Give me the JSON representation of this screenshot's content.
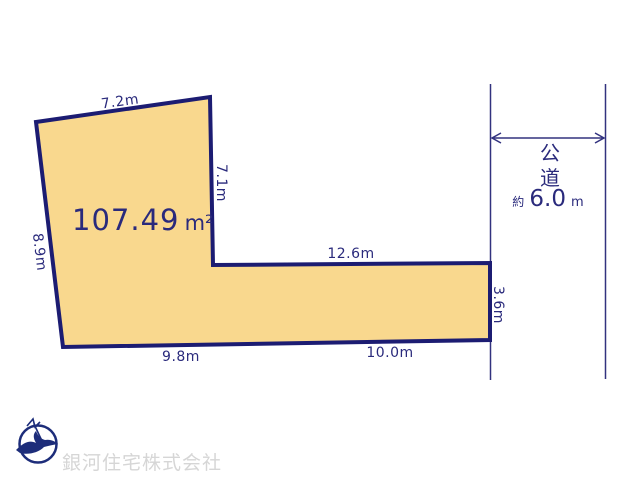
{
  "plot": {
    "area": {
      "value": "107.49",
      "unit": "m²"
    },
    "edges": {
      "top": "7.2m",
      "right_upper": "7.1m",
      "left": "8.9m",
      "inner_top": "12.6m",
      "right_lower": "3.6m",
      "bottom_left": "9.8m",
      "bottom_right": "10.0m"
    }
  },
  "road": {
    "name_chars": [
      "公",
      "道"
    ],
    "width": {
      "prefix": "約",
      "value": "6.0",
      "unit": "m"
    }
  },
  "footer": {
    "company_name": "銀河住宅株式会社",
    "logo_icon": "bird-compass-logo"
  },
  "colors": {
    "plot_fill": "#f9d88e",
    "plot_outline": "#1c1c72",
    "dimension_text": "#2a2a7c",
    "road_line": "#32327f",
    "company_text": "#d6d6d6",
    "logo_navy": "#1d2d7a"
  }
}
